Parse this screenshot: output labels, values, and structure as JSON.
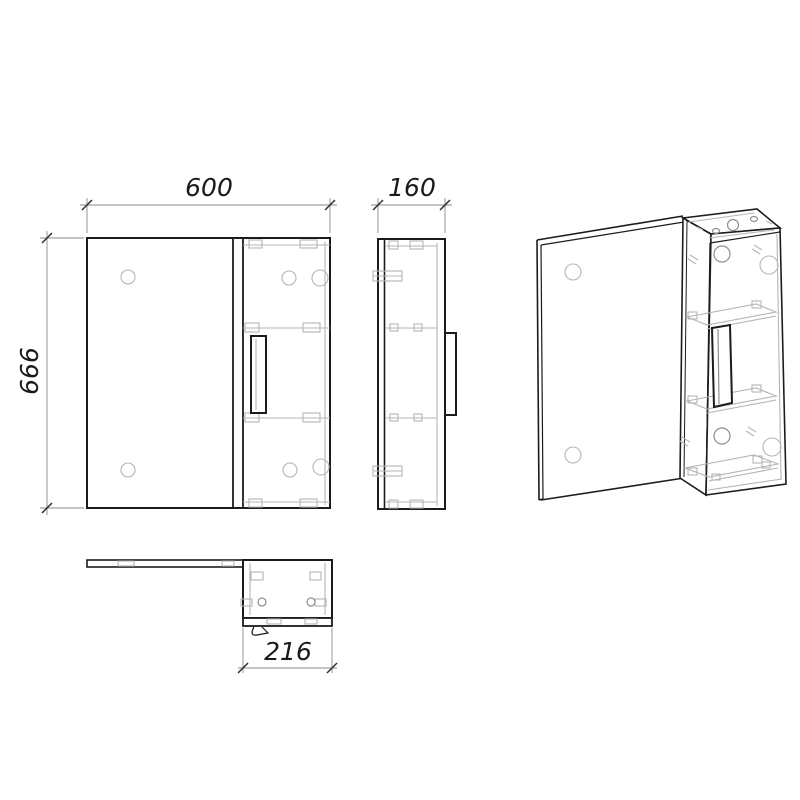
{
  "drawing": {
    "type": "furniture-technical-drawing",
    "subject": "mirror-cabinet",
    "labels": {
      "overall_width": "600",
      "depth": "160",
      "overall_height": "666",
      "cabinet_width": "216"
    },
    "colors": {
      "background": "#ffffff",
      "outline": "#1c1c1c",
      "detail": "#b5b5b5",
      "detail_strong": "#8f8f8f",
      "dimension_line": "#8a8a8a",
      "tick": "#2f2f2f",
      "text": "#1a1a1a"
    }
  }
}
